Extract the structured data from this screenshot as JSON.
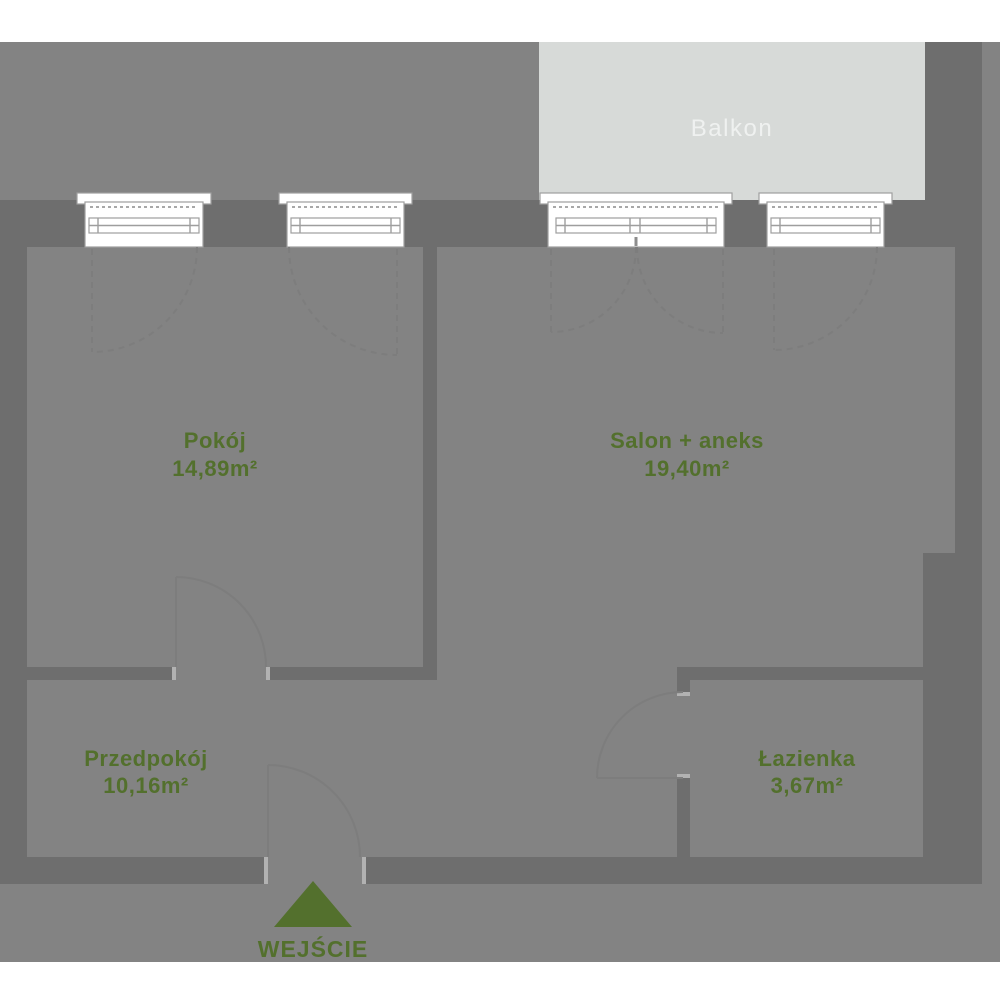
{
  "colors": {
    "site": "#838383",
    "wall": "#6e6e6e",
    "balcony": "#d7dad8",
    "balconyText": "#eff1f0",
    "green": "#53702d",
    "line": "#7d7d7d",
    "winline": "#9e9e9e",
    "dotted": "#a8a8a8",
    "jamb": "#b2b2b2"
  },
  "balcony": {
    "label": "Balkon"
  },
  "rooms": {
    "pokoj": {
      "name": "Pokój",
      "area": "14,89m²"
    },
    "salon": {
      "name": "Salon + aneks",
      "area": "19,40m²"
    },
    "przedpokoj": {
      "name": "Przedpokój",
      "area": "10,16m²"
    },
    "lazienka": {
      "name": "Łazienka",
      "area": "3,67m²"
    }
  },
  "entrance": {
    "label": "WEJŚCIE"
  }
}
